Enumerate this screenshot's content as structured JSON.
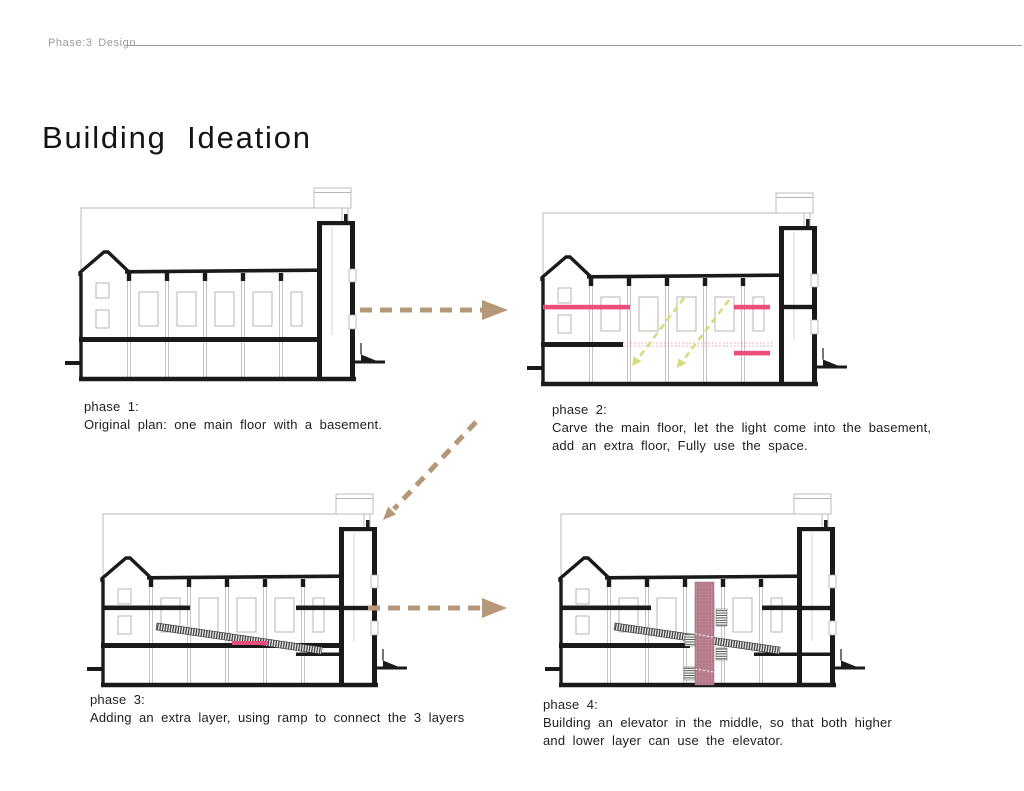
{
  "header": {
    "label": "Phase:3 Design"
  },
  "title": "Building Ideation",
  "phases": [
    {
      "label": "phase 1:",
      "lines": [
        "Original plan: one main floor with a basement."
      ]
    },
    {
      "label": "phase 2:",
      "lines": [
        "Carve the main floor, let the light come into the basement,",
        "add an extra floor, Fully use the space."
      ]
    },
    {
      "label": "phase 3:",
      "lines": [
        "Adding an extra layer, using ramp to connect the 3 layers"
      ]
    },
    {
      "label": "phase 4:",
      "lines": [
        "Building an elevator in the middle, so that both higher",
        "and lower layer can use the elevator."
      ]
    }
  ],
  "icons": {
    "arrow_phase1_to_phase2": "dashed-arrow-right",
    "arrow_phase2_to_phase3": "dashed-arrow-down-left",
    "arrow_phase3_to_phase4": "dashed-arrow-right"
  },
  "colors": {
    "arrow_tan": "#b49877",
    "highlight_pink": "#ec4d7b",
    "elevator_rose": "#b5798a",
    "light_ray_yellow": "#d8da7f",
    "header_gray": "#9b9b9b",
    "ink": "#1a1a1a"
  }
}
